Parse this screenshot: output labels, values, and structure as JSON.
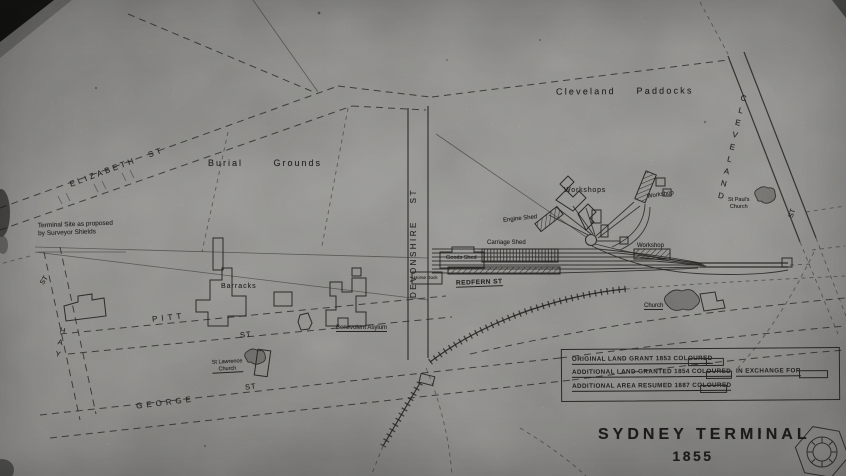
{
  "title": {
    "main": "SYDNEY  TERMINAL",
    "year": "1855"
  },
  "paddocks_label": "Cleveland   Paddocks",
  "burial_grounds_label": "Burial   Grounds",
  "streets": {
    "elizabeth": "ELIZABETH  ST",
    "hay": "HAY",
    "hay_st": "ST",
    "pitt": "PITT",
    "pitt_st": "ST",
    "george": "GEORGE",
    "george_st": "ST",
    "devonshire": "DEVONSHIRE  ST",
    "cleveland": "CLEVELAND",
    "cleveland_st": "ST",
    "redfern": "REDFERN  ST"
  },
  "buildings": {
    "workshops": "Workshops",
    "workshop_ne": "Workshop",
    "workshop_se": "Workshop",
    "engine_shed": "Engine Shed",
    "carriage_shed": "Carriage Shed",
    "goods_shed": "Goods Shed",
    "horse_dock": "Horse Dock",
    "barracks": "Barracks",
    "benevolent_asylum": "Benevolent Asylum",
    "st_lawrence_line1": "St Lawrence",
    "st_lawrence_line2": "Church",
    "st_pauls_line1": "St Paul's",
    "st_pauls_line2": "Church",
    "church": "Church"
  },
  "notes": {
    "terminal_site_line1": "Terminal Site as proposed",
    "terminal_site_line2": "by Surveyor Shields"
  },
  "legend": {
    "rows": [
      {
        "label": "ORIGINAL LAND GRANT 1853 COLOURED"
      },
      {
        "label": "ADDITIONAL LAND GRANTED 1854 COLOURED",
        "suffix": "IN EXCHANGE FOR"
      },
      {
        "label": "ADDITIONAL AREA RESUMED 1887 COLOURED"
      }
    ]
  },
  "colors": {
    "paper": "#cac9c5",
    "ink": "#2a2824"
  }
}
